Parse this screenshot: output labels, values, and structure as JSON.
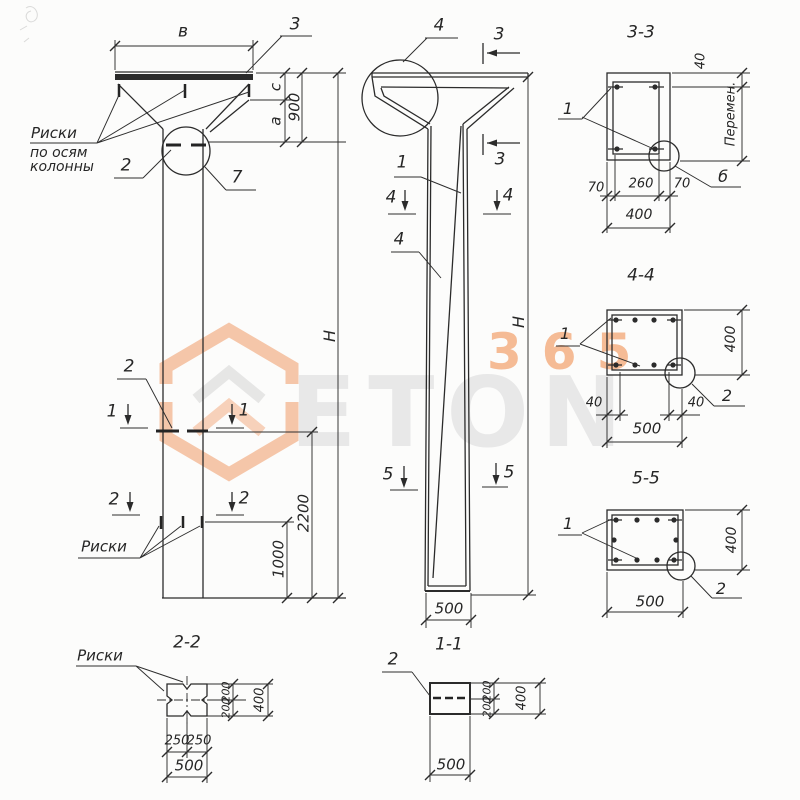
{
  "colors": {
    "ink": "#2b2b2b",
    "paper": "#fcfcfb",
    "accent_orange": "#f4ab7c",
    "watermark_gray": "#e8e8e8"
  },
  "watermark": {
    "word": "ETON",
    "digits": "365"
  },
  "drawing": {
    "front": {
      "dim_b": "в",
      "callout_3": "3",
      "dim_c": "с",
      "dim_a": "а",
      "dim_900": "900",
      "dim_H": "Н",
      "callout_2_top": "2",
      "callout_7": "7",
      "axis_note": [
        "Риски",
        "по осям",
        "колонны"
      ],
      "marker_1": "1",
      "callout_2_mid": "2",
      "dim_2200": "2200",
      "dim_1000": "1000",
      "marker_2": "2",
      "risk_note": "Риски"
    },
    "side": {
      "callout_4_top": "4",
      "marker_3": "3",
      "callout_1": "1",
      "callout_4_web": "4",
      "marker_4": "4",
      "marker_5": "5",
      "dim_H": "Н",
      "dim_500": "500"
    },
    "sec11": {
      "title": "1-1",
      "callout_2": "2",
      "dim_200": "200",
      "dim_400": "400",
      "dim_500": "500"
    },
    "sec22": {
      "title": "2-2",
      "risk_note": "Риски",
      "dim_200": "200",
      "dim_400": "400",
      "dim_250": "250",
      "dim_500": "500"
    },
    "sec33": {
      "title": "3-3",
      "callout_1": "1",
      "callout_6": "б",
      "dim_40": "40",
      "dim_var": "Перемен.",
      "dim_70": "70",
      "dim_260": "260",
      "dim_400": "400"
    },
    "sec44": {
      "title": "4-4",
      "callout_1": "1",
      "callout_2": "2",
      "dim_40": "40",
      "dim_400": "400",
      "dim_500": "500"
    },
    "sec55": {
      "title": "5-5",
      "callout_1": "1",
      "callout_2": "2",
      "dim_400": "400",
      "dim_500": "500"
    }
  }
}
